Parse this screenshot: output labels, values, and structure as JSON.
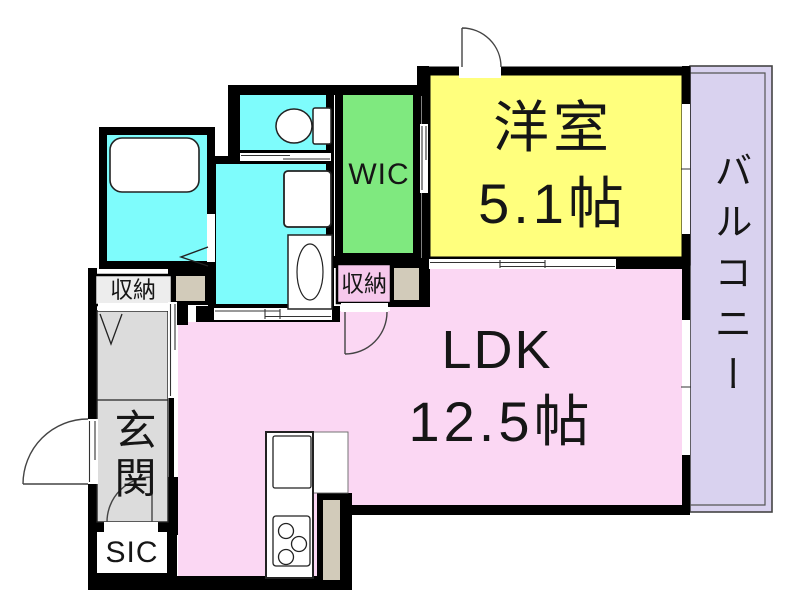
{
  "floorplan": {
    "rooms": {
      "western_room": {
        "name": "洋室",
        "area": "5.1帖"
      },
      "ldk": {
        "name": "LDK",
        "area": "12.5帖"
      },
      "wic": {
        "name": "WIC"
      },
      "balcony": {
        "name": "バルコニー"
      },
      "entrance": {
        "name": "玄関"
      },
      "shoe_closet": {
        "name": "SIC"
      },
      "storage_hall": {
        "name": "収納"
      },
      "storage_wic_side": {
        "name": "収納"
      }
    },
    "colors": {
      "wall": "#000000",
      "opening": "#ffffff",
      "wet_area": "#7efcfc",
      "wic_green": "#7fe97f",
      "western_yellow": "#ffff7d",
      "ldk_pink": "#fbd7f3",
      "storage2_pink": "#f6c8ec",
      "storage1_gray": "#ededed",
      "balcony_purple": "#d9d2ef",
      "genkan_gray": "#dcdcdc",
      "beige": "#d2cbba",
      "fixture_white": "#ffffff"
    }
  }
}
